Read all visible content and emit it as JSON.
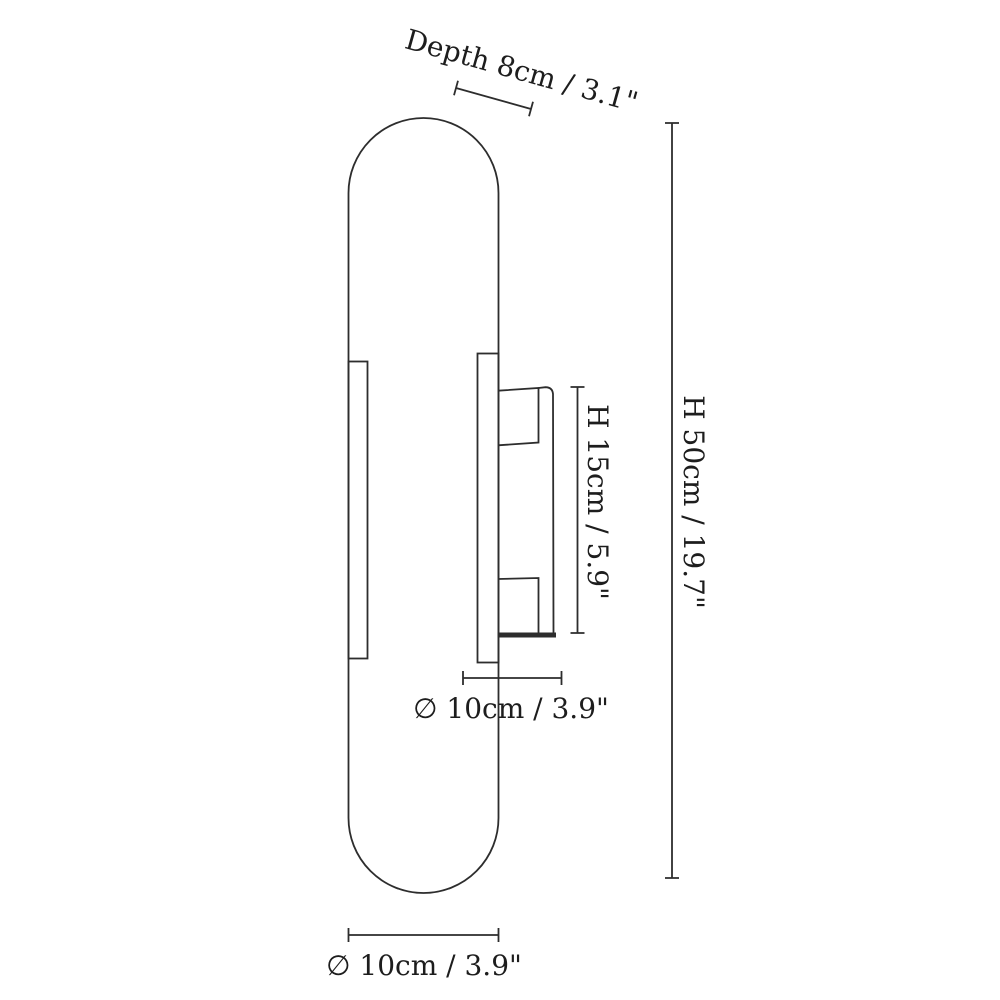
{
  "theme": {
    "line-color": "#2d2d2d",
    "text-color": "#1d1d1d",
    "background": "#ffffff"
  },
  "diagram": {
    "kind": "product-dimension-drawing",
    "dimensions": {
      "depth": {
        "label": "Depth 8cm / 3.1\"",
        "cm": 8,
        "inch": 3.1
      },
      "total_height": {
        "label": "H 50cm / 19.7\"",
        "cm": 50,
        "inch": 19.7
      },
      "fixture_height": {
        "label": "H 15cm / 5.9\"",
        "cm": 15,
        "inch": 5.9
      },
      "mid_diameter": {
        "label": "∅ 10cm / 3.9\"",
        "cm": 10,
        "inch": 3.9
      },
      "bottom_diameter": {
        "label": "∅ 10cm / 3.9\"",
        "cm": 10,
        "inch": 3.9
      }
    }
  }
}
